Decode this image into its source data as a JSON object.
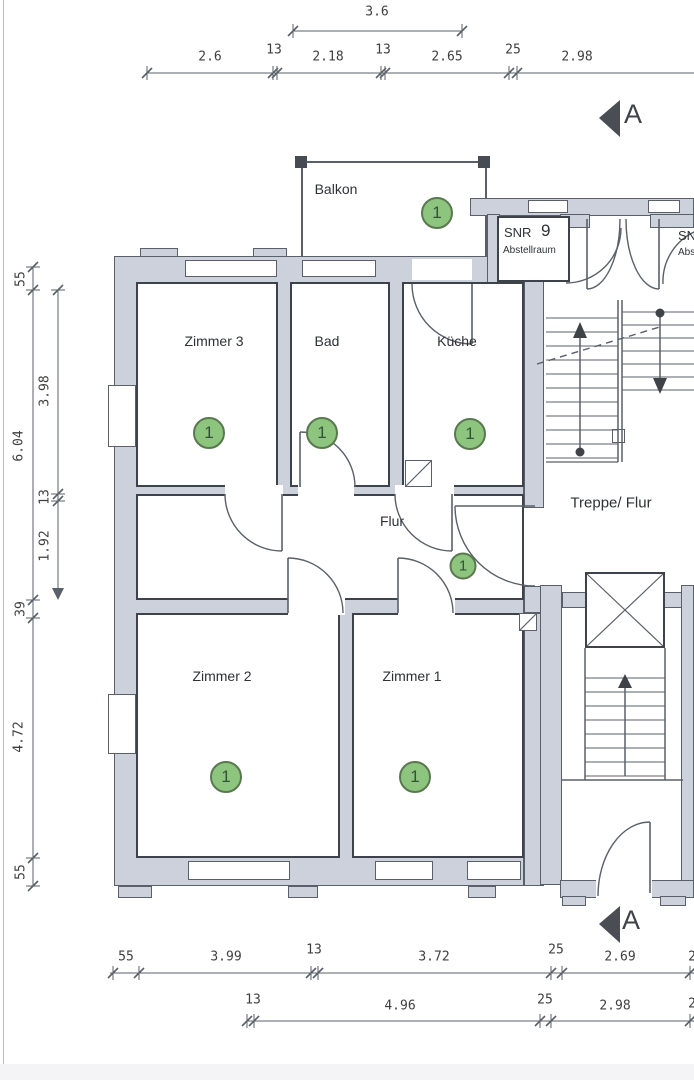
{
  "rooms": {
    "balkon": {
      "name": "Balkon",
      "marker": "1"
    },
    "zimmer3": {
      "name": "Zimmer 3",
      "marker": "1"
    },
    "bad": {
      "name": "Bad",
      "marker": "1"
    },
    "kueche": {
      "name": "Küche",
      "marker": "1"
    },
    "flur": {
      "name": "Flur",
      "marker": "1"
    },
    "treppe_flur": {
      "name": "Treppe/ Flur"
    },
    "zimmer2": {
      "name": "Zimmer 2",
      "marker": "1"
    },
    "zimmer1": {
      "name": "Zimmer 1",
      "marker": "1"
    },
    "abstellraum": {
      "label": "SNR",
      "number": "9",
      "sublabel": "Abstellraum"
    },
    "abstellraum_right_clipped": {
      "label": "SNR",
      "sublabel": "Abstellraum"
    }
  },
  "section_marker": {
    "top": "A",
    "bottom": "A"
  },
  "dimensions": {
    "top_detail": "3.6",
    "top_main": [
      "2.6",
      "13",
      "2.18",
      "13",
      "2.65",
      "25",
      "2.98"
    ],
    "left_outer": [
      "55",
      "6.04",
      "39",
      "4.72",
      "55"
    ],
    "left_inner": [
      "3.98",
      "13",
      "1.92"
    ],
    "bottom_main": [
      "55",
      "3.99",
      "13",
      "3.72",
      "25",
      "2.69"
    ],
    "bottom_lower": [
      "13",
      "4.96",
      "25",
      "2.98"
    ],
    "bottom_main_clipped": "2",
    "bottom_lower_clipped": "2"
  },
  "colors": {
    "wall_fill": "#cdd1db",
    "line": "#596069",
    "unit_green": "#8dc57e",
    "unit_green_border": "#59784f"
  }
}
